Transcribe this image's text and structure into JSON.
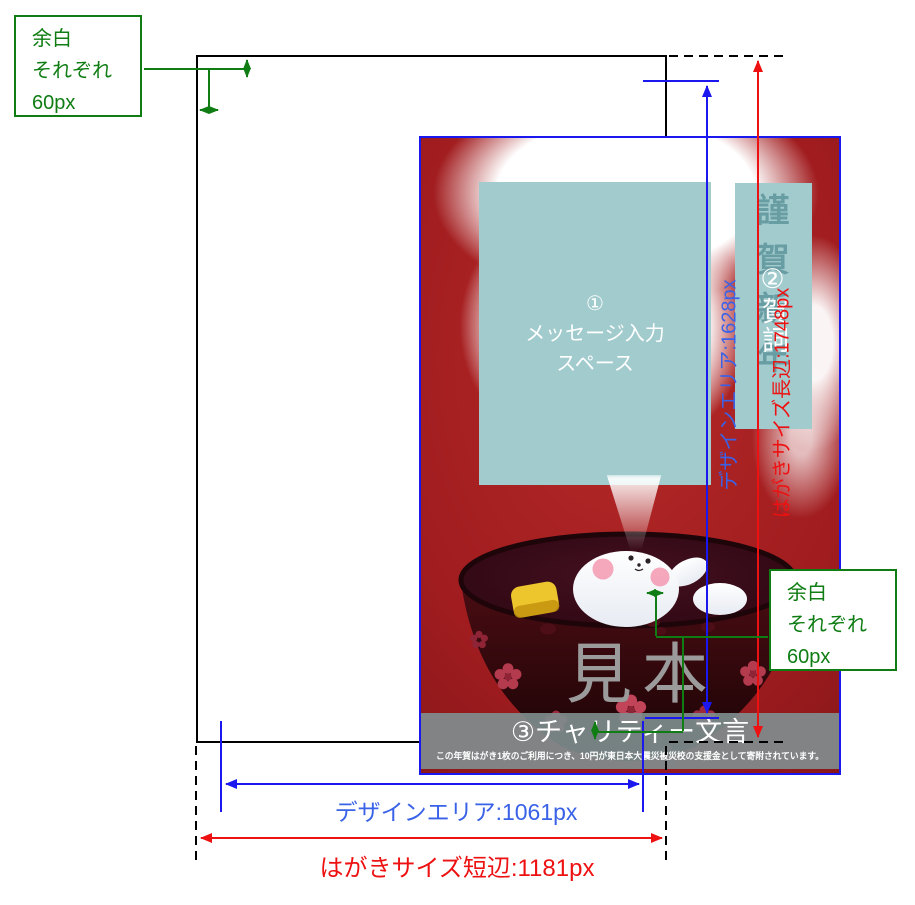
{
  "annotations": {
    "margin_note": {
      "line1": "余白",
      "line2": "それぞれ",
      "line3": "60px"
    },
    "design_height_label": "デザインエリア:1628px",
    "card_height_label": "はがきサイズ長辺:1748px",
    "design_width_label": "デザインエリア:1061px",
    "card_width_label": "はがきサイズ短辺:1181px"
  },
  "postcard": {
    "message_area": {
      "number": "①",
      "text_line1": "メッセージ入力",
      "text_line2": "スペース"
    },
    "greeting_area": {
      "background_text": "謹賀新年",
      "label": "②賀詞"
    },
    "watermark": "見本",
    "charity": {
      "label": "③チャリティー文言",
      "fine_print": "この年賀はがき1枚のご利用につき、10円が東日本大震災被災校の支援金として寄附されています。"
    }
  },
  "colors": {
    "design_border_blue": "#1a18ee",
    "dimension_red": "#ee1111",
    "margin_green": "#0f7d13",
    "card_red": "#a01c1f",
    "area_teal": "#a2cbce"
  }
}
